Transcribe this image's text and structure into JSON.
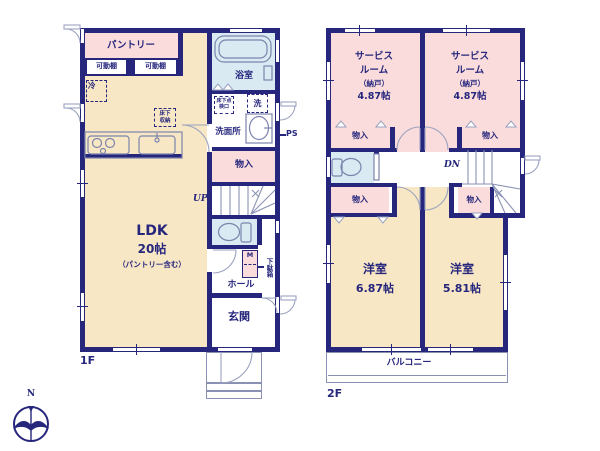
{
  "floor1": {
    "label": "1F",
    "pantry": "パントリー",
    "movable_shelf": "可動棚",
    "fridge": "冷",
    "underfloor_storage": "床下収納",
    "ldk": {
      "name": "LDK",
      "size": "20帖",
      "note": "（パントリー含む）"
    },
    "bath": "浴室",
    "underfloor_hatch": "床下点検口",
    "washer": "洗",
    "washroom": "洗面所",
    "pipe_space": "PS",
    "closet": "物入",
    "stairs_up": "UP",
    "meter_box": "M",
    "shoe_cabinet": "下駄箱",
    "hall": "ホール",
    "entrance": "玄関"
  },
  "floor2": {
    "label": "2F",
    "service_room_left": {
      "line1": "サービス",
      "line2": "ルーム",
      "line3": "（納戸）",
      "size": "4.87帖"
    },
    "service_room_right": {
      "line1": "サービス",
      "line2": "ルーム",
      "line3": "（納戸）",
      "size": "4.87帖"
    },
    "closet": "物入",
    "stairs_down": "DN",
    "bedroom_left": {
      "name": "洋室",
      "size": "6.87帖"
    },
    "bedroom_right": {
      "name": "洋室",
      "size": "5.81帖"
    },
    "balcony": "バルコニー"
  },
  "compass": {
    "north": "N"
  },
  "colors": {
    "wall": "#26267d",
    "floor_ldk": "#f7e7c4",
    "floor_pink": "#fadcdc",
    "floor_blue": "#d9eaf2",
    "fixture_line": "#7c84ad"
  }
}
